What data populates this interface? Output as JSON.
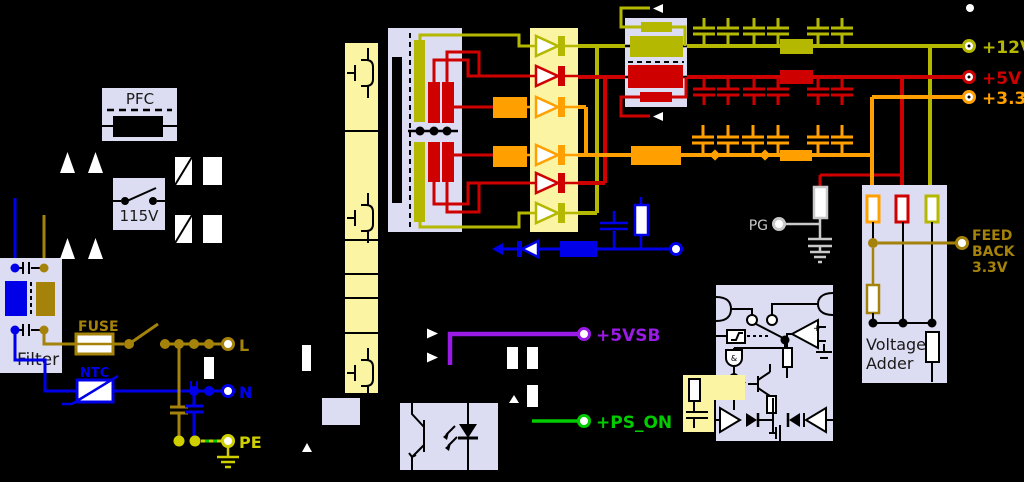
{
  "title": "ATX power supply schematic",
  "palette": {
    "background": "#000000",
    "rail_12v": "#b4b800",
    "rail_5v": "#cf0000",
    "rail_3v3": "#ffa000",
    "rail_5vsb": "#9a1ae6",
    "rail_ps_on": "#00cc00",
    "rail_minus": "#0000e8",
    "line_brown": "#a5820a",
    "earth_yellow": "#cfcf00",
    "pg_gray": "#c9c9c9",
    "block_lavender": "#dcdcf2",
    "block_yellow": "#fbf4a2"
  },
  "blocks": {
    "pfc": "PFC",
    "selector": "115V",
    "filter": "Filter",
    "fuse": "FUSE",
    "ntc": "NTC",
    "adder_line1": "Voltage",
    "adder_line2": "Adder"
  },
  "input_terminals": {
    "line": "L",
    "neutral": "N",
    "earth": "PE"
  },
  "outputs": {
    "v12": "+12V",
    "v5": "+5V",
    "v3v3": "+3.3V",
    "v5sb": "+5VSB",
    "ps_on": "+PS_ON",
    "pg": "PG"
  },
  "feedback": {
    "l1": "FEED",
    "l2": "BACK",
    "l3": "3.3V"
  }
}
